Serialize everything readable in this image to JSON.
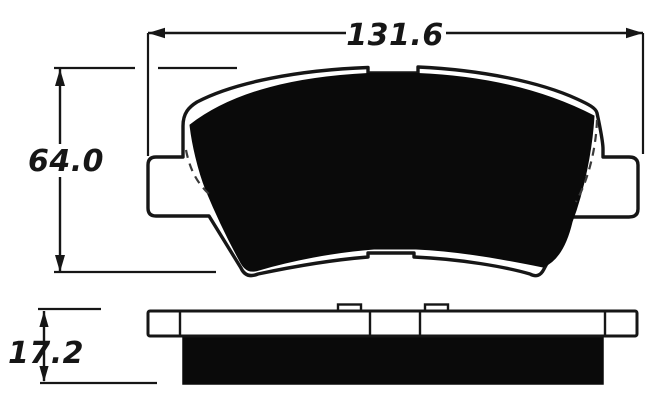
{
  "dimensions": {
    "width_label": "131.6",
    "height_label": "64.0",
    "thickness_label": "17.2"
  },
  "colors": {
    "ink": "#161616",
    "background": "#ffffff",
    "friction_fill": "#0a0a0a"
  }
}
